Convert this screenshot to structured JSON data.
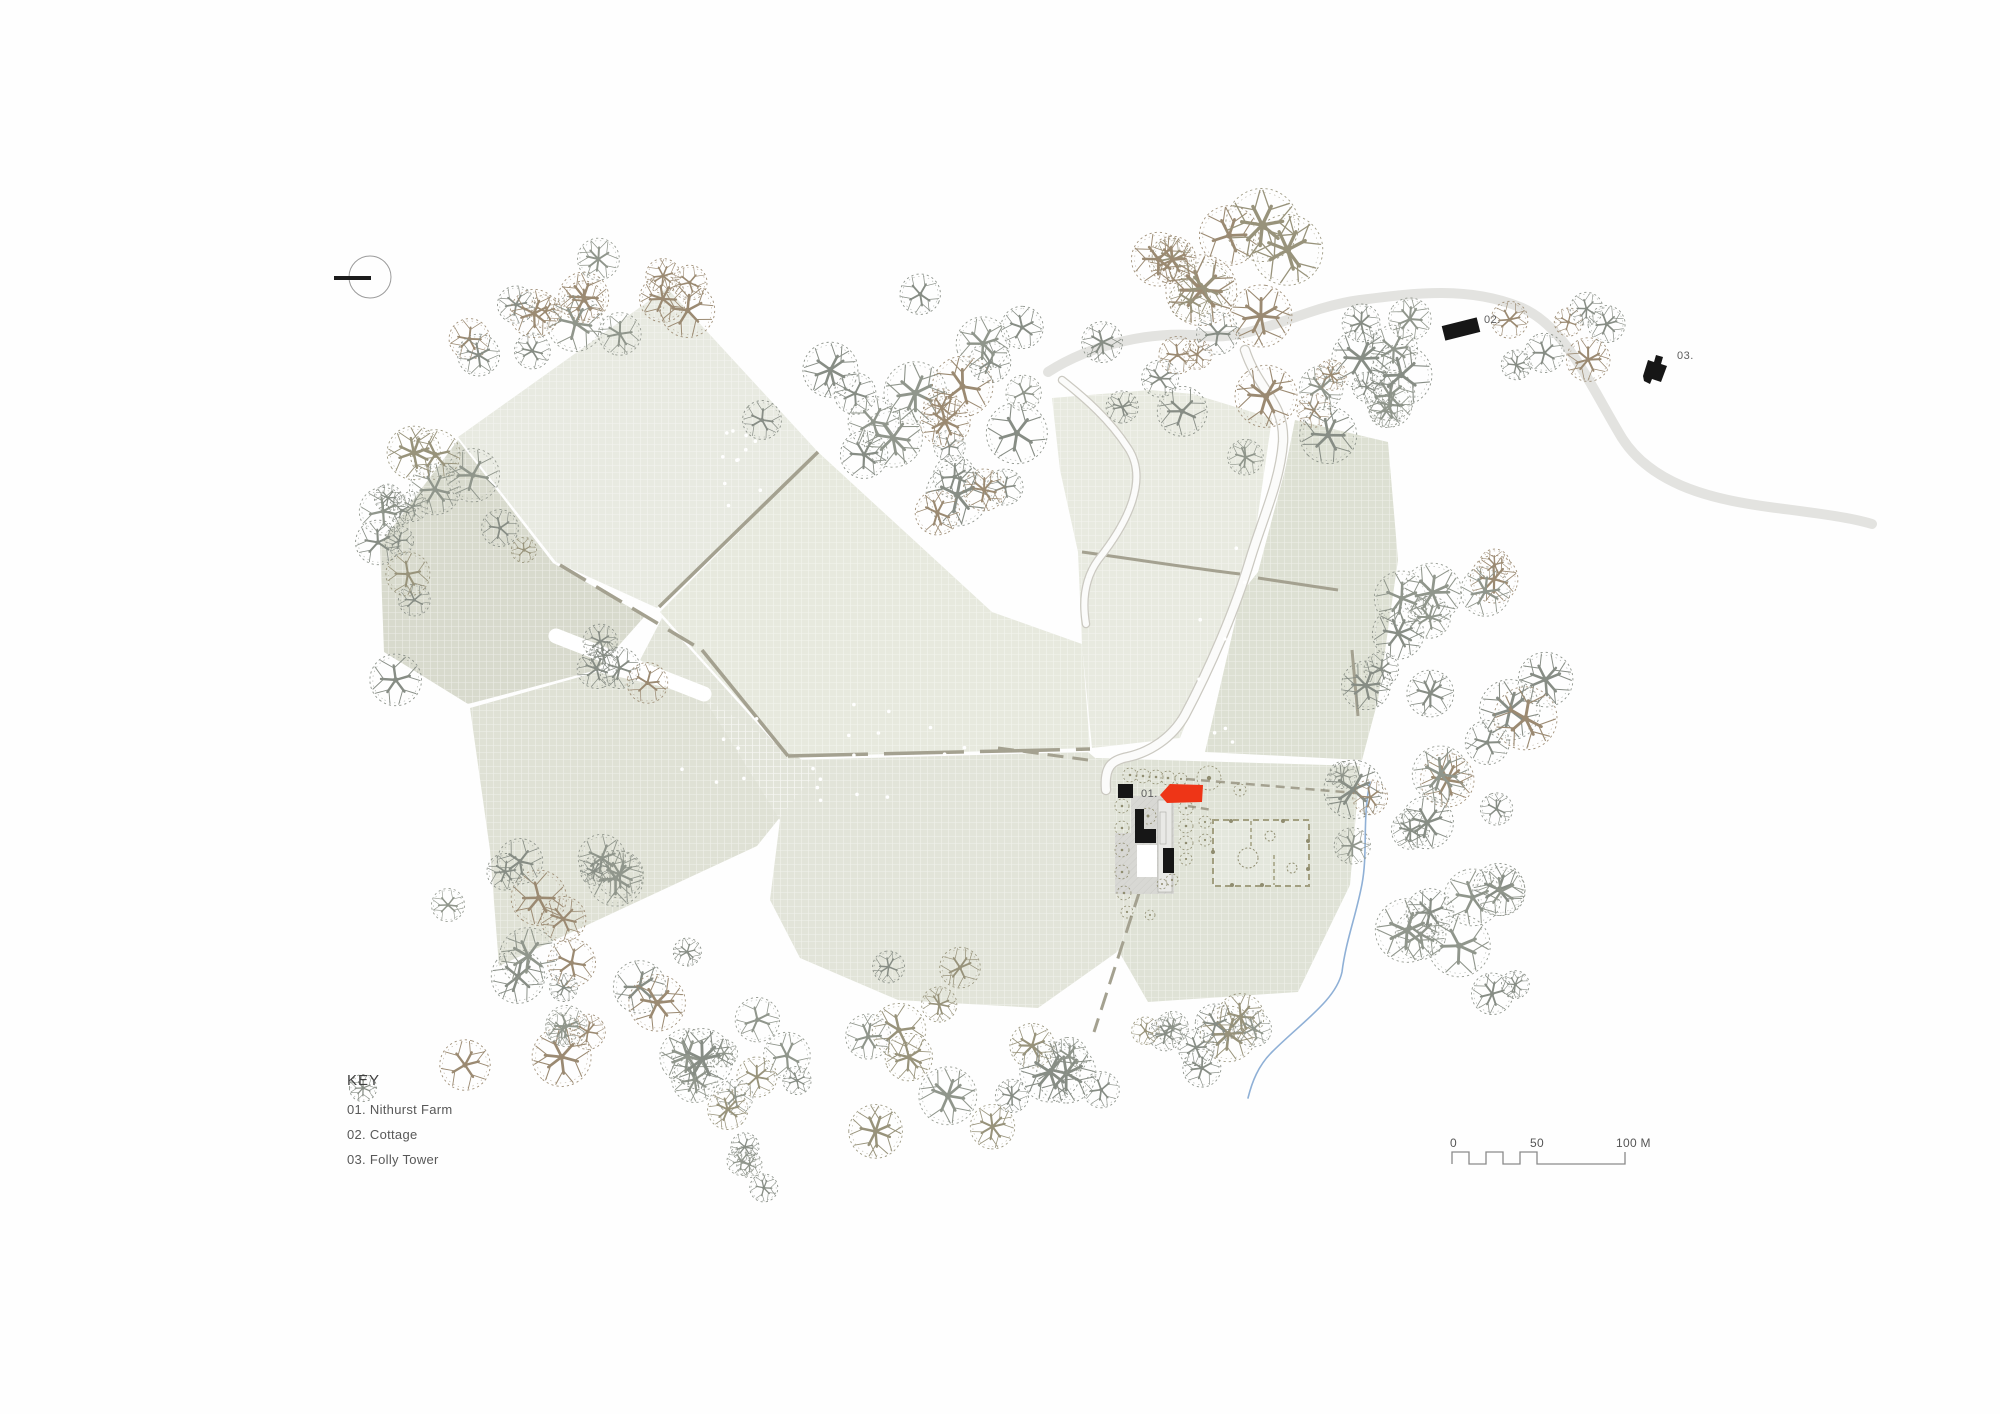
{
  "title": "Nithurst Farm site plan",
  "key": {
    "title": "KEY",
    "items": [
      "01. Nithurst Farm",
      "02. Cottage",
      "03. Folly Tower"
    ]
  },
  "scalebar": {
    "labels": [
      "0",
      "50",
      "100 M"
    ]
  },
  "labels": {
    "farm": "01.",
    "cottage": "02.",
    "folly": "03."
  },
  "colors": {
    "red": "#ee3517",
    "black": "#161616",
    "hedge": "#a4a190",
    "lane": "#e3e3e0",
    "drive_case": "#cbc9c1",
    "stream": "#8fb0d6",
    "shrub": "#8f8c6f",
    "garden": "#a29f80",
    "courtyard": "#d8d8d4",
    "label": "#5c5c5c",
    "tree": {
      "g": "#878d85",
      "g2": "#90968c",
      "b": "#9b8a72",
      "o": "#98937b"
    },
    "field": {
      "f1": "#e8eae1",
      "f2": "#d8dacd",
      "f3": "#dfe1d5",
      "f4": "#e7e9de",
      "f5": "#e2e4d9",
      "f6": "#e8eae0",
      "f7": "#dde0d3",
      "f8": "#dfe2d6"
    }
  },
  "map": {
    "fields": [
      {
        "id": "f1",
        "pts": "667,288 818,452 657,608 556,562 458,437"
      },
      {
        "id": "f4",
        "pts": "818,452 992,612 1082,644 1090,748 790,757 660,612"
      },
      {
        "id": "f2",
        "pts": "458,440 553,563 645,616 597,670 468,704 384,652 380,544"
      },
      {
        "id": "f3",
        "pts": "470,708 597,672 700,695 818,770 757,846 499,966 490,850"
      },
      {
        "id": "f5",
        "pts": "662,618 790,760 1088,752 1112,772 1118,890 1140,893 1117,952 1038,1008 898,1000 800,958 770,900 780,820 705,700 640,660"
      },
      {
        "id": "f6",
        "pts": "1052,398 1150,390 1193,394 1272,418 1250,570 1238,592 1180,738 1092,748 1082,645 1078,552 1060,470"
      },
      {
        "id": "f7",
        "pts": "1295,420 1388,442 1398,560 1378,700 1362,760 1205,752 1242,592 1258,572 1285,470"
      },
      {
        "id": "f8",
        "pts": "1095,758 1360,766 1350,885 1298,992 1148,1002 1118,950 1140,894 1118,890 1112,772"
      }
    ],
    "track": {
      "d": "M556,636 L704,694",
      "w": 15
    },
    "hedges": [
      {
        "d": "M818,452 L659,607",
        "w": 3.5
      },
      {
        "d": "M560,565 L702,650",
        "w": 3.5,
        "dash": "30 12"
      },
      {
        "d": "M702,650 L788,756",
        "w": 3.5
      },
      {
        "d": "M788,756 L1090,749",
        "w": 3.5,
        "dash": "80 16"
      },
      {
        "d": "M1082,552 C1140,560 1190,568 1240,574",
        "w": 3
      },
      {
        "d": "M1258,578 L1338,590",
        "w": 3
      },
      {
        "d": "M1186,779 L1356,793",
        "w": 2.5,
        "dash": "9 6"
      },
      {
        "d": "M1188,806 L1212,810",
        "w": 2.5,
        "dash": "8 5"
      },
      {
        "d": "M1140,890 L1094,1032",
        "w": 3,
        "dash": "18 9"
      },
      {
        "d": "M998,748 L1088,760",
        "w": 3,
        "dash": "16 9"
      },
      {
        "d": "M1352,650 L1358,716",
        "w": 3
      }
    ],
    "lane": {
      "d": "M1048,372 C1090,345 1150,330 1205,336 C1255,341 1300,308 1360,300 C1415,293 1468,286 1520,307 C1565,325 1590,385 1622,438 C1650,482 1705,498 1762,506 C1805,512 1845,516 1872,524",
      "w": 10
    },
    "drives": [
      {
        "d": "M1245,350 C1258,390 1285,402 1283,442 C1280,482 1262,520 1250,560 C1235,610 1210,668 1185,715 C1172,738 1150,752 1128,757 C1112,760 1104,766 1106,790",
        "w": 8
      },
      {
        "d": "M1062,380 C1085,398 1110,420 1128,448 C1148,478 1130,520 1098,560 C1085,578 1082,600 1086,624",
        "w": 6
      }
    ],
    "stream": {
      "d": "M1370,782 C1362,820 1368,852 1362,884 C1356,916 1346,940 1342,972 C1336,1000 1302,1022 1272,1052 C1258,1066 1252,1082 1248,1098",
      "w": 1.6
    },
    "garden": {
      "x": 1213,
      "y": 820,
      "w": 96,
      "h": 66,
      "lines": [
        "M1251,821 L1251,849",
        "M1274,855 L1274,885"
      ],
      "circles": [
        [
          1248,
          858,
          10
        ],
        [
          1270,
          836,
          5
        ],
        [
          1292,
          868,
          5
        ]
      ],
      "dots": [
        [
          1231,
          821
        ],
        [
          1283,
          821
        ],
        [
          1308,
          841
        ],
        [
          1308,
          869
        ],
        [
          1232,
          885
        ],
        [
          1262,
          885
        ],
        [
          1213,
          852
        ]
      ]
    },
    "courtyard": {
      "pts": "1131,796 1174,796 1174,894 1115,894 1115,833 1131,833",
      "inner": [
        1137,
        845,
        20,
        32
      ],
      "range": [
        1158,
        800,
        14,
        92
      ],
      "range_inner": [
        1160,
        812,
        6,
        32
      ]
    },
    "buildings": {
      "farm_red": "1160,795 1170,784 1203,785 1202,802 1167,803",
      "barn": "1118,784 1133,784 1133,798 1118,798",
      "lshape": "1135,809 1144,809 1144,829 1156,829 1156,843 1135,843",
      "store": "1163,848 1174,848 1174,873 1163,873",
      "cottage": {
        "cx": 1461,
        "cy": 329,
        "w": 36,
        "h": 15,
        "rot": -14
      },
      "folly": "1643,376 1648,360 1654,362 1656,355 1663,357 1661,364 1667,366 1661,382 1652,379 1650,384 1644,381"
    },
    "shrubs": [
      [
        1130,
        775,
        7
      ],
      [
        1143,
        776,
        7
      ],
      [
        1156,
        777,
        7
      ],
      [
        1168,
        778,
        7
      ],
      [
        1181,
        779,
        6
      ],
      [
        1122,
        806,
        7
      ],
      [
        1122,
        828,
        7
      ],
      [
        1122,
        850,
        7
      ],
      [
        1122,
        872,
        7
      ],
      [
        1124,
        893,
        7
      ],
      [
        1127,
        912,
        6
      ],
      [
        1186,
        808,
        7
      ],
      [
        1186,
        826,
        7
      ],
      [
        1186,
        843,
        7
      ],
      [
        1186,
        859,
        6
      ],
      [
        1205,
        822,
        6
      ],
      [
        1205,
        840,
        6
      ],
      [
        1172,
        880,
        6
      ],
      [
        1162,
        884,
        5
      ],
      [
        1148,
        816,
        8
      ],
      [
        1209,
        778,
        12
      ],
      [
        1240,
        790,
        6
      ],
      [
        1150,
        915,
        5
      ]
    ],
    "tree_clusters": [
      [
        665,
        300,
        112,
        52,
        9,
        16,
        32,
        11,
        [
          "g",
          "b",
          "g2"
        ]
      ],
      [
        475,
        325,
        85,
        52,
        6,
        14,
        26,
        12,
        [
          "g",
          "b"
        ]
      ],
      [
        432,
        575,
        60,
        142,
        13,
        14,
        28,
        13,
        [
          "g",
          "o",
          "g2"
        ]
      ],
      [
        635,
        663,
        62,
        28,
        5,
        15,
        25,
        14,
        [
          "g",
          "b"
        ]
      ],
      [
        560,
        950,
        130,
        120,
        19,
        14,
        32,
        15,
        [
          "g",
          "g2",
          "b"
        ]
      ],
      [
        975,
        1058,
        295,
        100,
        34,
        14,
        32,
        16,
        [
          "g",
          "o",
          "g2"
        ]
      ],
      [
        1452,
        790,
        112,
        245,
        32,
        14,
        33,
        17,
        [
          "g",
          "g2",
          "b"
        ]
      ],
      [
        965,
        400,
        162,
        118,
        23,
        15,
        33,
        18,
        [
          "g",
          "b",
          "g2"
        ]
      ],
      [
        1298,
        385,
        172,
        98,
        21,
        15,
        32,
        19,
        [
          "g",
          "b",
          "g2"
        ]
      ],
      [
        1228,
        264,
        118,
        46,
        9,
        20,
        38,
        20,
        [
          "b",
          "o",
          "b"
        ]
      ],
      [
        1560,
        350,
        72,
        54,
        7,
        12,
        24,
        21,
        [
          "g",
          "b"
        ]
      ],
      [
        768,
        1158,
        66,
        33,
        4,
        13,
        20,
        22,
        [
          "g",
          "g2"
        ]
      ]
    ],
    "tree_singles": [
      [
        465,
        1065,
        26,
        "b"
      ],
      [
        363,
        1088,
        14,
        "g"
      ],
      [
        500,
        528,
        19,
        "g"
      ],
      [
        524,
        550,
        13,
        "o"
      ],
      [
        762,
        420,
        20,
        "g"
      ],
      [
        448,
        905,
        17,
        "g2"
      ]
    ],
    "sheep": [
      [
        738,
        470,
        26,
        46,
        11,
        31
      ],
      [
        825,
        752,
        160,
        52,
        20,
        32
      ],
      [
        1228,
        648,
        34,
        105,
        8,
        33
      ]
    ],
    "north": {
      "cx": 370,
      "cy": 277,
      "r": 21
    },
    "label_pos": {
      "farm": [
        1141,
        797
      ],
      "cottage": [
        1484,
        323
      ],
      "folly": [
        1677,
        359
      ]
    }
  }
}
